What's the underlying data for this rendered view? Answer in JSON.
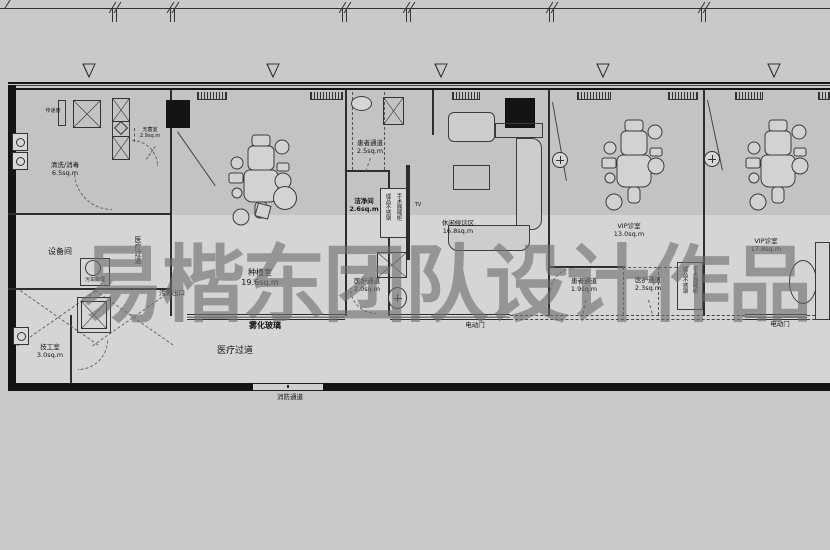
{
  "watermark": "易楷东团队设计作品",
  "plan": {
    "rooms": [
      {
        "name": "清洗/消毒",
        "area": "6.5sq.m"
      },
      {
        "name": "无菌室",
        "area": "2.9sq.m"
      },
      {
        "name": "设备间",
        "area": ""
      },
      {
        "name": "技工室",
        "area": "3.0sq.m"
      },
      {
        "name": "种植室",
        "area": "19.6sq.m"
      },
      {
        "name": "患者通道",
        "area": "2.5sq.m"
      },
      {
        "name": "洁净间",
        "area": "2.6sq.m"
      },
      {
        "name": "医护通道",
        "area": "2.0sq.m"
      },
      {
        "name": "休闲候诊区",
        "area": "16.8sq.m"
      },
      {
        "name": "患者通道",
        "area": "1.9sq.m"
      },
      {
        "name": "医护通道",
        "area": "2.3sq.m"
      },
      {
        "name": "VIP诊室",
        "area": "13.0sq.m"
      },
      {
        "name": "VIP诊室",
        "area": "17.8sq.m"
      }
    ],
    "annotations": {
      "pass_window": "传递窗",
      "waste_exit": "污物出口",
      "fog_glass": "雾化玻璃",
      "medical_aisle": "医疗过道",
      "medical_aisle_vertical": "医疗过道",
      "fire_passage": "消防通道",
      "electric_door_left": "电动门",
      "electric_door_right": "电动门",
      "tv": "TV",
      "waste_cart": "污车处理",
      "cabinet_line1": "成品不锈钢",
      "cabinet_line2": "手术器械柜"
    }
  }
}
